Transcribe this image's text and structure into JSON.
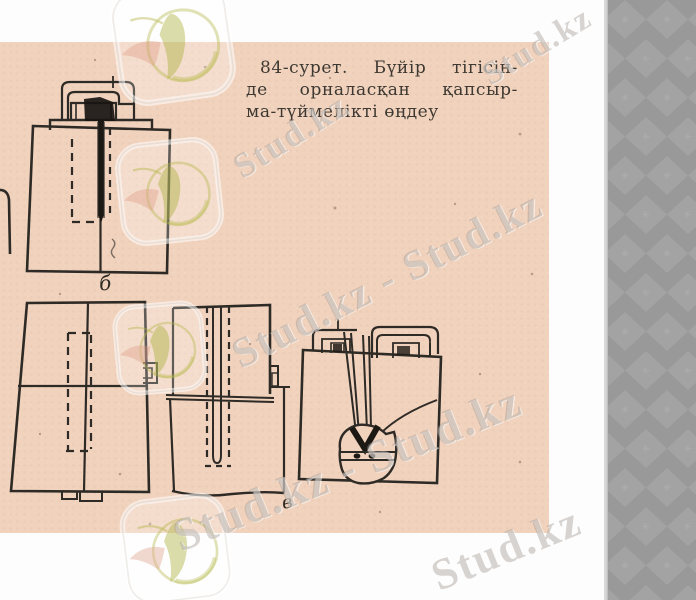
{
  "page": {
    "bg_color": "#f0d2bd",
    "ink_color": "#2e2a25",
    "caption": {
      "line1": "84-сурет. Бүйір тігісін-",
      "line2": "де орналасқан қапсыр-",
      "line3": "ма-түймелікті өңдеу"
    },
    "figure_labels": {
      "a": "б",
      "b": "в"
    }
  },
  "watermark": {
    "text": "Stud.kz",
    "text_pair": "Stud.kz - Stud.kz",
    "logo_icon": "stud-kz-hummingbird-logo",
    "text_color": "#9e938c",
    "logo_green": "#b9bc52",
    "logo_pink": "#dd9b85"
  },
  "sidebar": {
    "pattern": "argyle-diamonds",
    "base_color": "#999999",
    "diamond_color": "#a3a3a3",
    "motif": "cross",
    "border_color": "#d9d9d9"
  }
}
